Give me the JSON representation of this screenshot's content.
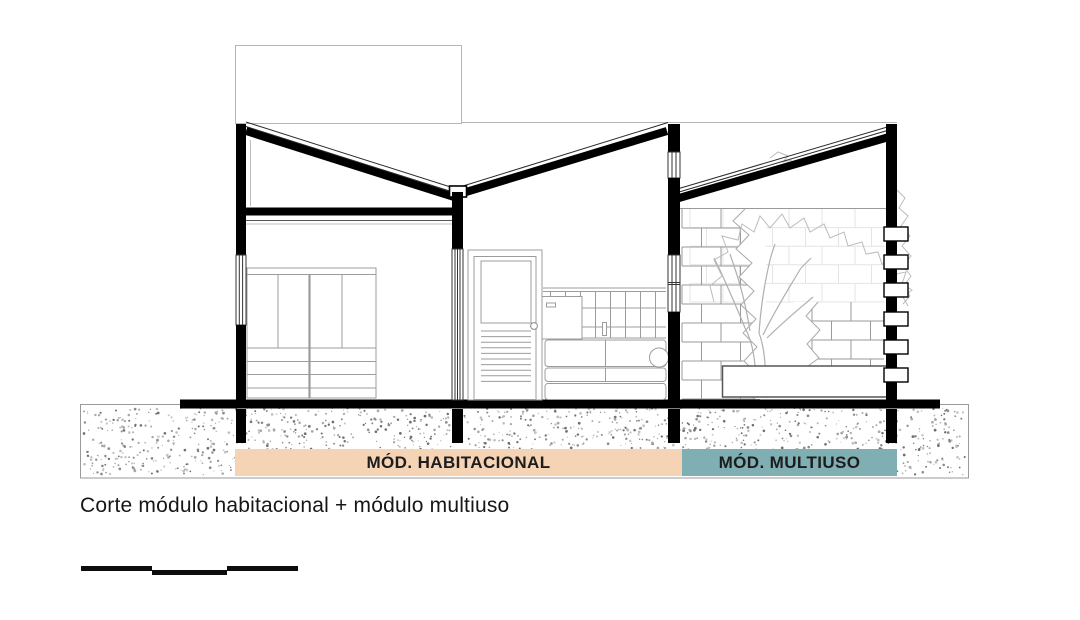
{
  "drawing": {
    "caption": "Corte módulo habitacional + módulo multiuso",
    "ink_color": "#000000",
    "label_text_color": "#1d1d1d",
    "modules": [
      {
        "id": "habitacional",
        "label": "MÓD. HABITACIONAL",
        "band_color": "#F5D3B5"
      },
      {
        "id": "multiuso",
        "label": "MÓD. MULTIUSO",
        "band_color": "#7FAEB3"
      }
    ]
  }
}
